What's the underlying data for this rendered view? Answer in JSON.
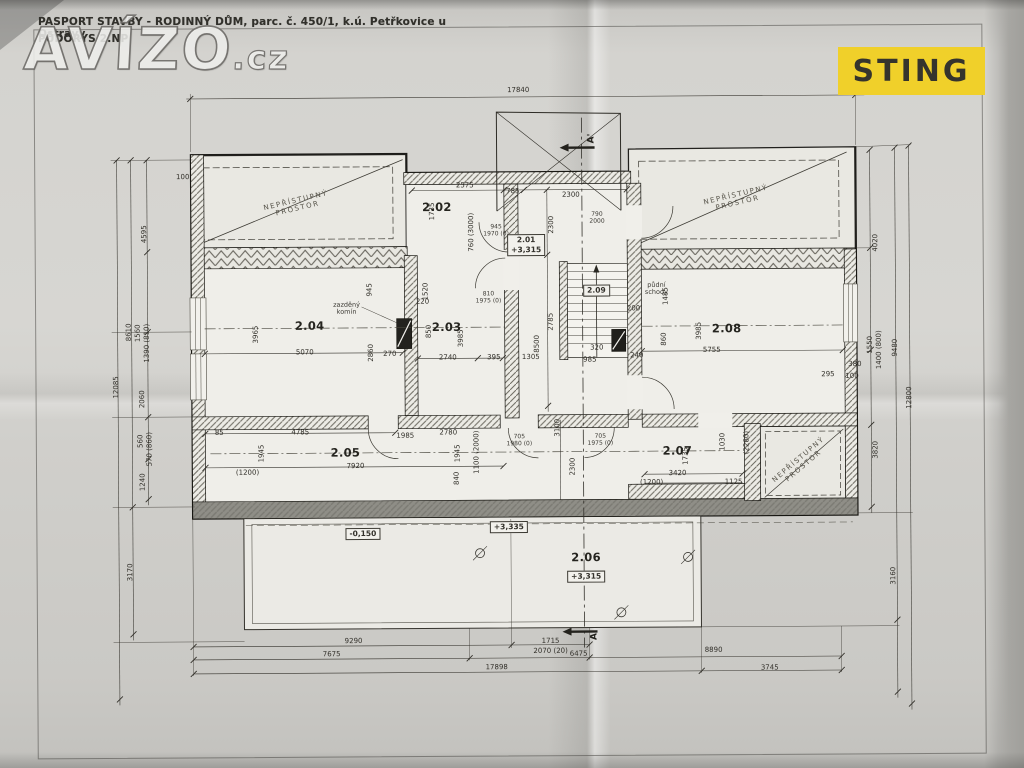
{
  "header": {
    "title_line1": "PASPORT STAVBY - RODINNÝ DŮM, parc. č. 450/1, k.ú. Petřkovice u Ostravy",
    "title_line2": "PŮDORYS 2.NP"
  },
  "watermark": {
    "main": "AVÍZO",
    "suffix": ".cz"
  },
  "logo": {
    "text": "STING",
    "bg_color": "#f0d02a",
    "text_color": "#35342d"
  },
  "plan": {
    "labels": [
      {
        "t": "2.02",
        "x": 438,
        "y": 207,
        "c": "room"
      },
      {
        "t": "2.04",
        "x": 310,
        "y": 325,
        "c": "room"
      },
      {
        "t": "2.03",
        "x": 447,
        "y": 327,
        "c": "room"
      },
      {
        "t": "2.08",
        "x": 727,
        "y": 330,
        "c": "room"
      },
      {
        "t": "2.05",
        "x": 345,
        "y": 452,
        "c": "room"
      },
      {
        "t": "2.07",
        "x": 677,
        "y": 452,
        "c": "room"
      },
      {
        "t": "2.06",
        "x": 585,
        "y": 558,
        "c": "room"
      },
      {
        "t": "2.01\n+3,315",
        "x": 527,
        "y": 245,
        "c": "box"
      },
      {
        "t": "2.09",
        "x": 597,
        "y": 291,
        "c": "box"
      },
      {
        "t": "+3,315",
        "x": 585,
        "y": 577,
        "c": "box"
      },
      {
        "t": "+3,335",
        "x": 508,
        "y": 527,
        "c": "box"
      },
      {
        "t": "-0,150",
        "x": 362,
        "y": 533,
        "c": "box"
      },
      {
        "t": "zazděný\nkomín",
        "x": 347,
        "y": 308,
        "c": "note"
      },
      {
        "t": "půdní\nschody",
        "x": 657,
        "y": 290,
        "c": "note"
      },
      {
        "t": "NEPŘÍSTUPNÝ\nPROSTOR",
        "x": 298,
        "y": 204,
        "r": -13,
        "c": "diag"
      },
      {
        "t": "NEPŘÍSTUPNÝ\nPROSTOR",
        "x": 738,
        "y": 201,
        "r": -13,
        "c": "diag"
      },
      {
        "t": "NEPŘÍSTUPNÝ\nPROSTOR",
        "x": 801,
        "y": 465,
        "r": -40,
        "c": "diag"
      },
      {
        "t": "945\n1970 (0)",
        "x": 497,
        "y": 231,
        "c": "spec"
      },
      {
        "t": "810\n1975 (0)",
        "x": 489,
        "y": 298,
        "c": "spec"
      },
      {
        "t": "705\n1980 (0)",
        "x": 519,
        "y": 441,
        "c": "spec"
      },
      {
        "t": "705\n1975 (0)",
        "x": 600,
        "y": 441,
        "c": "spec"
      },
      {
        "t": "790\n2000",
        "x": 598,
        "y": 219,
        "c": "spec"
      },
      {
        "t": "17840",
        "x": 520,
        "y": 91
      },
      {
        "t": "2575",
        "x": 466,
        "y": 186
      },
      {
        "t": "785",
        "x": 514,
        "y": 192
      },
      {
        "t": "2300",
        "x": 572,
        "y": 196
      },
      {
        "t": "5070",
        "x": 305,
        "y": 352
      },
      {
        "t": "270",
        "x": 390,
        "y": 354
      },
      {
        "t": "2740",
        "x": 448,
        "y": 358
      },
      {
        "t": "395",
        "x": 494,
        "y": 358
      },
      {
        "t": "220",
        "x": 423,
        "y": 302
      },
      {
        "t": "1305",
        "x": 531,
        "y": 358
      },
      {
        "t": "5755",
        "x": 712,
        "y": 352
      },
      {
        "t": "240",
        "x": 637,
        "y": 357
      },
      {
        "t": "200",
        "x": 634,
        "y": 310
      },
      {
        "t": "320",
        "x": 597,
        "y": 349
      },
      {
        "t": "985",
        "x": 590,
        "y": 361
      },
      {
        "t": "380",
        "x": 855,
        "y": 367
      },
      {
        "t": "295",
        "x": 828,
        "y": 377
      },
      {
        "t": "100",
        "x": 852,
        "y": 379
      },
      {
        "t": "100",
        "x": 184,
        "y": 176
      },
      {
        "t": "4785",
        "x": 300,
        "y": 432
      },
      {
        "t": "85",
        "x": 219,
        "y": 432
      },
      {
        "t": "1985",
        "x": 405,
        "y": 436
      },
      {
        "t": "2780",
        "x": 448,
        "y": 433
      },
      {
        "t": "7920",
        "x": 355,
        "y": 466
      },
      {
        "t": "(1200)",
        "x": 247,
        "y": 472
      },
      {
        "t": "3420",
        "x": 677,
        "y": 475
      },
      {
        "t": "(1200)",
        "x": 651,
        "y": 484
      },
      {
        "t": "1125",
        "x": 733,
        "y": 484
      },
      {
        "t": "9290",
        "x": 352,
        "y": 641
      },
      {
        "t": "1715",
        "x": 549,
        "y": 642
      },
      {
        "t": "2070 (20)",
        "x": 549,
        "y": 652
      },
      {
        "t": "7675",
        "x": 330,
        "y": 654
      },
      {
        "t": "6475",
        "x": 577,
        "y": 655
      },
      {
        "t": "8890",
        "x": 712,
        "y": 652
      },
      {
        "t": "17898",
        "x": 495,
        "y": 668
      },
      {
        "t": "3745",
        "x": 768,
        "y": 670
      },
      {
        "t": "1735",
        "x": 434,
        "y": 211,
        "r": -90
      },
      {
        "t": "760 (3000)",
        "x": 473,
        "y": 232,
        "r": -90
      },
      {
        "t": "3965",
        "x": 257,
        "y": 333,
        "r": -90
      },
      {
        "t": "945",
        "x": 371,
        "y": 289,
        "r": -90
      },
      {
        "t": "1520",
        "x": 427,
        "y": 291,
        "r": -90
      },
      {
        "t": "2860",
        "x": 372,
        "y": 352,
        "r": -90
      },
      {
        "t": "850",
        "x": 430,
        "y": 331,
        "r": -90
      },
      {
        "t": "3985",
        "x": 462,
        "y": 338,
        "r": -90
      },
      {
        "t": "2300",
        "x": 553,
        "y": 225,
        "r": -90
      },
      {
        "t": "2785",
        "x": 552,
        "y": 322,
        "r": -90
      },
      {
        "t": "8500",
        "x": 538,
        "y": 344,
        "r": -90
      },
      {
        "t": "3100",
        "x": 558,
        "y": 428,
        "r": -90
      },
      {
        "t": "2300",
        "x": 573,
        "y": 467,
        "r": -90
      },
      {
        "t": "3985",
        "x": 700,
        "y": 332,
        "r": -90
      },
      {
        "t": "1485",
        "x": 667,
        "y": 297,
        "r": -90
      },
      {
        "t": "860",
        "x": 665,
        "y": 340,
        "r": -90
      },
      {
        "t": "4595",
        "x": 146,
        "y": 232,
        "r": -90
      },
      {
        "t": "1560",
        "x": 139,
        "y": 331,
        "r": -90
      },
      {
        "t": "1390 (810)",
        "x": 148,
        "y": 341,
        "r": -90
      },
      {
        "t": "2060",
        "x": 143,
        "y": 397,
        "r": -90
      },
      {
        "t": "560",
        "x": 141,
        "y": 439,
        "r": -90
      },
      {
        "t": "570 (860)",
        "x": 150,
        "y": 447,
        "r": -90
      },
      {
        "t": "1240",
        "x": 143,
        "y": 480,
        "r": -90
      },
      {
        "t": "8610",
        "x": 130,
        "y": 330,
        "r": -90
      },
      {
        "t": "3170",
        "x": 130,
        "y": 570,
        "r": -90
      },
      {
        "t": "12085",
        "x": 117,
        "y": 385,
        "r": -90
      },
      {
        "t": "4020",
        "x": 877,
        "y": 245,
        "r": -90
      },
      {
        "t": "1550",
        "x": 871,
        "y": 347,
        "r": -90
      },
      {
        "t": "1400 (800)",
        "x": 880,
        "y": 352,
        "r": -90
      },
      {
        "t": "3820",
        "x": 876,
        "y": 452,
        "r": -90
      },
      {
        "t": "9480",
        "x": 896,
        "y": 350,
        "r": -90
      },
      {
        "t": "3160",
        "x": 893,
        "y": 578,
        "r": -90
      },
      {
        "t": "12800",
        "x": 910,
        "y": 400,
        "r": -90
      },
      {
        "t": "1945",
        "x": 262,
        "y": 452,
        "r": -90
      },
      {
        "t": "1945",
        "x": 458,
        "y": 453,
        "r": -90
      },
      {
        "t": "840",
        "x": 457,
        "y": 478,
        "r": -90
      },
      {
        "t": "1100 (2000)",
        "x": 477,
        "y": 452,
        "r": -90
      },
      {
        "t": "1735",
        "x": 686,
        "y": 457,
        "r": -90
      },
      {
        "t": "1030",
        "x": 723,
        "y": 443,
        "r": -90
      },
      {
        "t": "(2280)",
        "x": 747,
        "y": 444,
        "r": -90
      },
      {
        "t": "A'",
        "x": 593,
        "y": 139,
        "r": -90,
        "c": "sect"
      },
      {
        "t": "A",
        "x": 593,
        "y": 637,
        "r": -90,
        "c": "sect"
      }
    ]
  }
}
